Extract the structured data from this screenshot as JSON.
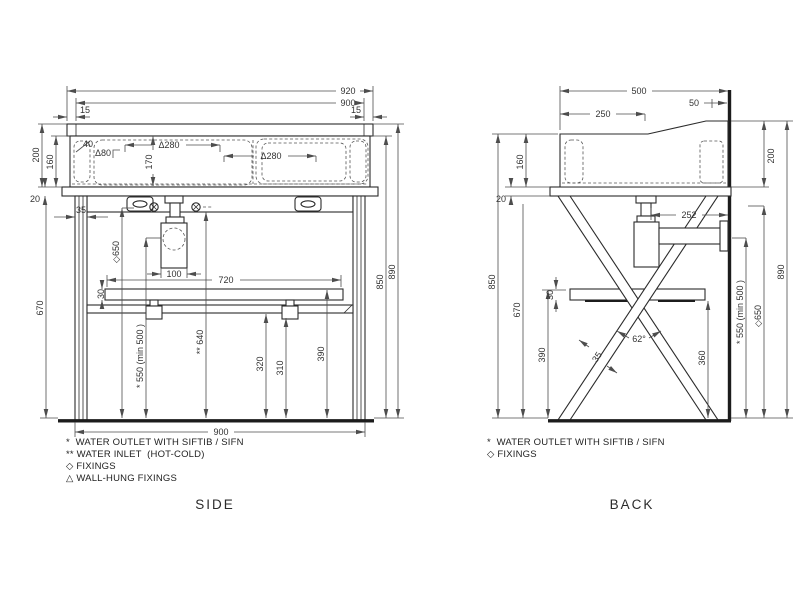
{
  "colors": {
    "background": "#ffffff",
    "object_line": "#2b2b2b",
    "dimension_line": "#4d4d4d",
    "text": "#333333"
  },
  "views": {
    "side": {
      "label": "SIDE",
      "dims": {
        "overall_width": "920",
        "basin_width": "900",
        "end_left": "15",
        "end_right": "15",
        "corner": "40",
        "fixing_inset": "Δ80",
        "fixing_pitch_left": "Δ280",
        "fixing_pitch_right": "Δ280",
        "basin_depth": "170",
        "height_back": "200",
        "height_front": "160",
        "top_thickness": "20",
        "leg_width": "35",
        "outlet_fixing_height": "◇650",
        "trap_width": "100",
        "shelf_width": "720",
        "shelf_thickness": "30",
        "underside_height": "670",
        "rim_height": "850",
        "total_height": "890",
        "water_outlet_height": "* 550 (min 500 )",
        "water_inlet_height": "** 640",
        "rail_height": "320",
        "bracket_height": "310",
        "shelf_height": "390",
        "base_width": "900"
      },
      "notes": [
        "*  WATER OUTLET WITH SIFTIB / SIFN",
        "** WATER INLET  (HOT-COLD)",
        "◇ FIXINGS",
        "△ WALL-HUNG FIXINGS"
      ]
    },
    "back": {
      "label": "BACK",
      "dims": {
        "overall_depth": "500",
        "splash_depth": "50",
        "front_flat": "250",
        "height_front": "160",
        "top_thickness": "20",
        "rim_height": "850",
        "underside_height": "670",
        "shelf_height": "390",
        "shelf_thickness": "30",
        "height_back": "200",
        "total_height": "890",
        "outlet_fixing_height": "◇650",
        "water_outlet_height": "* 550 (min 500 )",
        "trap_to_wall": "252",
        "leg_angle": "62°",
        "leg_width": "35",
        "shelf_underside_height": "360"
      },
      "notes": [
        "*  WATER OUTLET WITH SIFTIB / SIFN",
        "◇ FIXINGS"
      ]
    }
  }
}
